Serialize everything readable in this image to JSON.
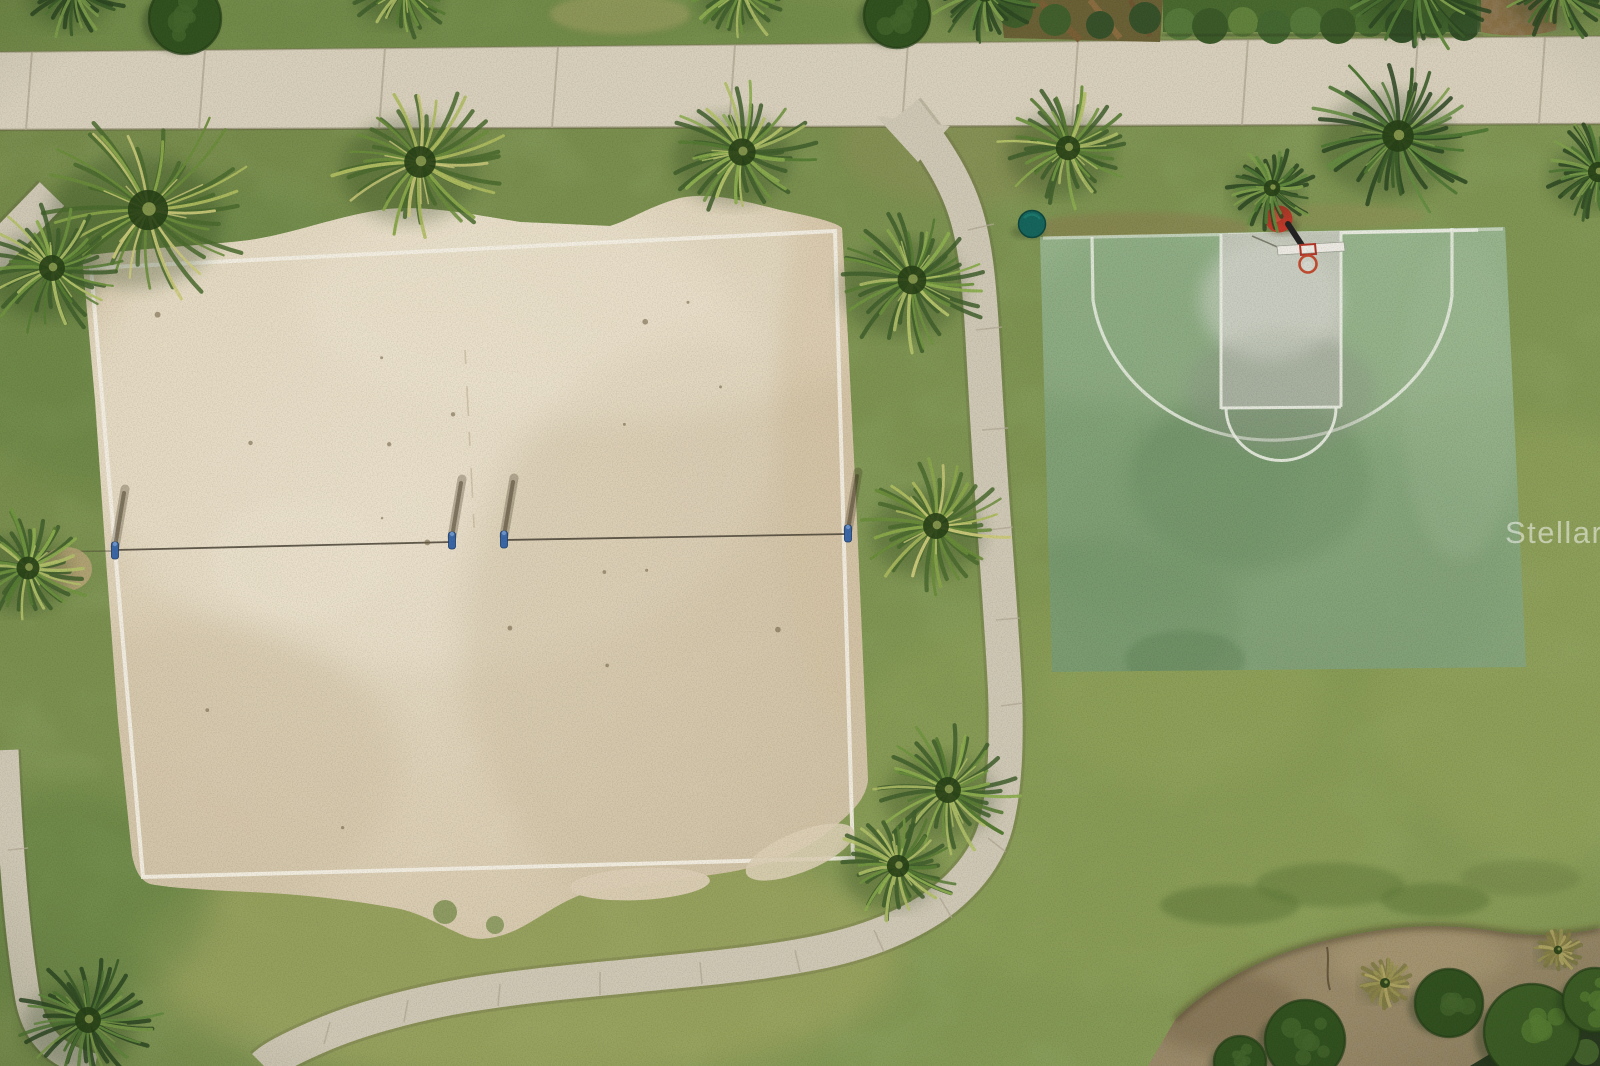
{
  "photo": {
    "description": "aerial-drone-photo-park-volleyball-basketball-courts",
    "watermark": {
      "brand": "StellarMLS",
      "part1": "Stellar",
      "part2": "MLS"
    }
  },
  "palette": {
    "grass": "#7e9452",
    "grassDark": "#5e7f40",
    "grassLight": "#a9ac66",
    "sand": "#dccfb5",
    "sandLight": "#eee5d1",
    "sandShade": "#cbbc9e",
    "sandLine": "#f3efe3",
    "concrete": "#d8d0bc",
    "concreteJoint": "#b3aa95",
    "pathConcrete": "#cfc8b5",
    "courtGreen": "#8fad83",
    "courtGreenDark": "#6d8f63",
    "courtKeyGray": "#c2c6ba",
    "courtLine": "#eaede2",
    "hoopRed": "#c2392b",
    "rimOrange": "#c14a2f",
    "poleBlack": "#232323",
    "backboardWhite": "#eceae2",
    "netPostBlue": "#3a67a6",
    "netPostBlueDark": "#1f3c66",
    "netLine": "#4a4336",
    "tealDisc": "#15655c",
    "hedgeGreen": "#48692f",
    "mulchBrown": "#9a8a68",
    "mulchDark": "#6f5d42",
    "bushDark": "#31511f",
    "bushLeafy": "#3d5f26",
    "palmShadow": "#243a18",
    "dirtTan": "#b9a478",
    "watermarkColor": "#ffffff"
  },
  "scene": {
    "sidewalk": {
      "joints": [
        32,
        205,
        385,
        558,
        735,
        908,
        1078,
        1248,
        1418,
        1545
      ]
    },
    "walkpath": {
      "ticks": [
        [
          968,
          230,
          994,
          224
        ],
        [
          976,
          330,
          1002,
          327
        ],
        [
          982,
          430,
          1008,
          428
        ],
        [
          989,
          530,
          1013,
          527
        ],
        [
          996,
          620,
          1020,
          618
        ],
        [
          1001,
          706,
          1023,
          703
        ],
        [
          988,
          838,
          1006,
          852
        ],
        [
          940,
          898,
          952,
          918
        ],
        [
          874,
          930,
          884,
          952
        ],
        [
          795,
          950,
          800,
          972
        ],
        [
          700,
          962,
          702,
          984
        ],
        [
          600,
          972,
          600,
          995
        ],
        [
          500,
          984,
          498,
          1006
        ],
        [
          408,
          1000,
          404,
          1022
        ],
        [
          330,
          1022,
          324,
          1044
        ],
        [
          8,
          850,
          28,
          848
        ]
      ]
    },
    "volleyball": {
      "anchor": [
        12,
        552,
        115,
        551
      ],
      "nets": [
        [
          115,
          550,
          452,
          542
        ],
        [
          504,
          540,
          848,
          534
        ]
      ],
      "posts": [
        [
          115,
          551
        ],
        [
          452,
          541
        ],
        [
          504,
          540
        ],
        [
          848,
          534
        ]
      ]
    },
    "palmPalettes": [
      [
        "#3f5e2b",
        "#567b33",
        "#6f943f",
        "#8dad4f",
        "#b3c169"
      ],
      [
        "#2c4722",
        "#3c5d2a",
        "#4f7634",
        "#648c40",
        "#7fa04c"
      ],
      [
        "#4a6a2e",
        "#6a8c3a",
        "#8aa74a",
        "#aebb5f",
        "#cbc97a"
      ],
      [
        "#7f7a44",
        "#9a9354",
        "#b3a866",
        "#8a8148"
      ]
    ],
    "palms": [
      [
        75,
        -10,
        55,
        1
      ],
      [
        405,
        -12,
        55,
        0
      ],
      [
        742,
        -10,
        52,
        0
      ],
      [
        985,
        -8,
        54,
        1
      ],
      [
        1420,
        -18,
        78,
        1
      ],
      [
        1560,
        -12,
        58,
        1
      ],
      [
        148,
        210,
        112,
        2
      ],
      [
        52,
        268,
        72,
        0
      ],
      [
        420,
        162,
        88,
        2
      ],
      [
        742,
        152,
        76,
        0
      ],
      [
        1068,
        148,
        68,
        0
      ],
      [
        1398,
        136,
        88,
        1
      ],
      [
        1272,
        188,
        46,
        1
      ],
      [
        1598,
        172,
        56,
        1
      ],
      [
        912,
        280,
        80,
        0
      ],
      [
        936,
        526,
        72,
        2
      ],
      [
        948,
        790,
        72,
        0
      ],
      [
        28,
        568,
        64,
        0
      ],
      [
        88,
        1020,
        72,
        1
      ],
      [
        898,
        866,
        62,
        0
      ],
      [
        1385,
        983,
        28,
        3
      ],
      [
        1558,
        950,
        24,
        3
      ]
    ],
    "bushes": [
      [
        1305,
        1040,
        40,
        "dark"
      ],
      [
        1449,
        1003,
        34,
        "dark"
      ],
      [
        1240,
        1062,
        26,
        "dark"
      ],
      [
        1532,
        1032,
        48,
        "leafy"
      ],
      [
        1595,
        1000,
        32,
        "leafy"
      ],
      [
        185,
        18,
        36,
        "dark"
      ],
      [
        897,
        15,
        33,
        "dark"
      ]
    ],
    "sandDebris": {
      "count": 18,
      "seed": 7
    }
  }
}
